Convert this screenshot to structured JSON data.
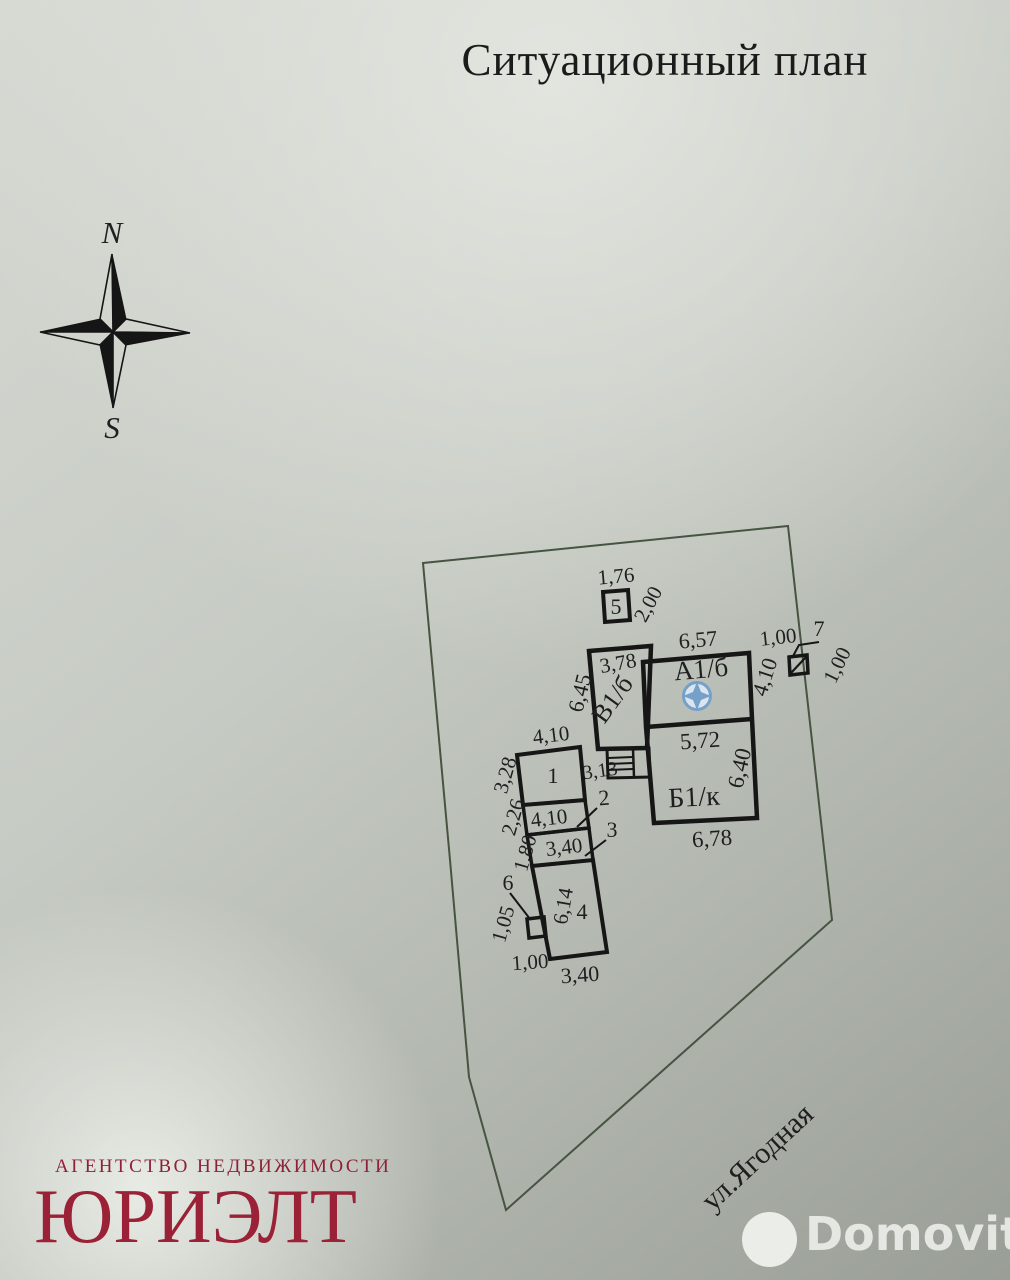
{
  "title": "Ситуационный план",
  "compass": {
    "north": "N",
    "south": "S"
  },
  "plan": {
    "street": "ул.Ягодная",
    "labels": {
      "a1b": "А1/б",
      "b1k": "Б1/к",
      "v1b": "В1/б"
    },
    "structures": {
      "n1": "1",
      "n2": "2",
      "n3": "3",
      "n4": "4",
      "n5": "5",
      "n6": "6",
      "n7": "7"
    },
    "dims": {
      "top_176": "1,76",
      "right_200": "2,00",
      "a1b_657": "6,57",
      "seven_100": "1,00",
      "seven_100r": "1,00",
      "v1b_378": "3,78",
      "v1b_645": "6,45",
      "a1b_410": "4,10",
      "b1k_572": "5,72",
      "b1k_640": "6,40",
      "b1k_678": "6,78",
      "porch_313": "3,13",
      "s1_410": "4,10",
      "s1_328": "3,28",
      "s2_410": "4,10",
      "s2_226": "2,26",
      "s3_340": "3,40",
      "s3_180": "1,80",
      "s6_105": "1,05",
      "s4_614": "6,14",
      "s4_100": "1,00",
      "s4_340": "3,40"
    }
  },
  "footer": {
    "agency_tagline": "АГЕНТСТВО НЕДВИЖИМОСТИ",
    "agency_name": "ЮРИЭЛТ",
    "watermark": "Domovita"
  },
  "colors": {
    "ink": "#1f1f1f",
    "boundary_green": "#465441",
    "logo_red": "#9b2136",
    "marker_blue": "#76a0c8",
    "compass_north_blue": "#2b3c76",
    "compass_south_red": "#8c4150"
  }
}
